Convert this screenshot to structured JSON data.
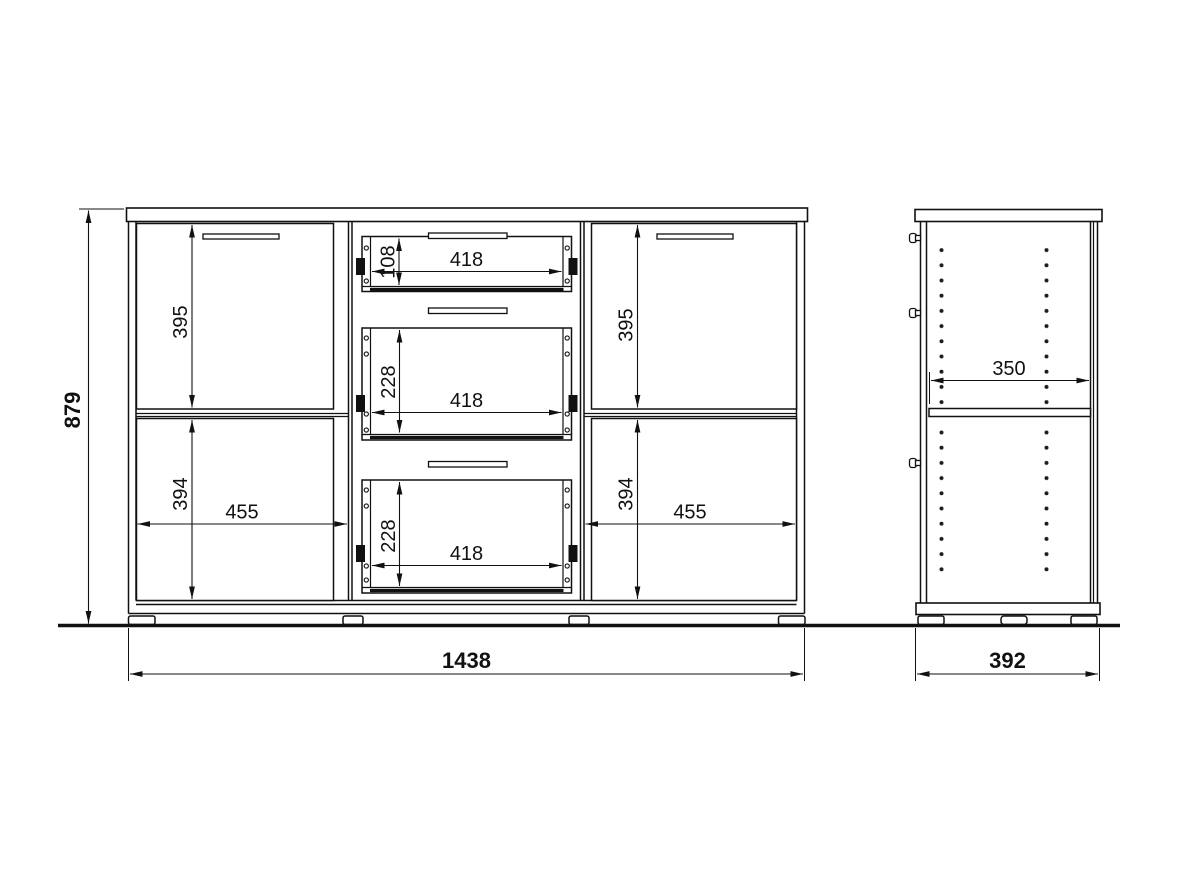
{
  "dimensions": {
    "front": {
      "overall_height": "879",
      "overall_width": "1438",
      "upper_left_door_height": "395",
      "lower_left_door_height": "394",
      "left_compartment_width": "455",
      "upper_right_door_height": "395",
      "lower_right_door_height": "394",
      "right_compartment_width": "455",
      "top_drawer_height": "108",
      "top_drawer_width": "418",
      "middle_drawer_height": "228",
      "middle_drawer_width": "418",
      "bottom_drawer_height": "228",
      "bottom_drawer_width": "418"
    },
    "side": {
      "overall_depth": "392",
      "shelf_depth": "350"
    }
  }
}
